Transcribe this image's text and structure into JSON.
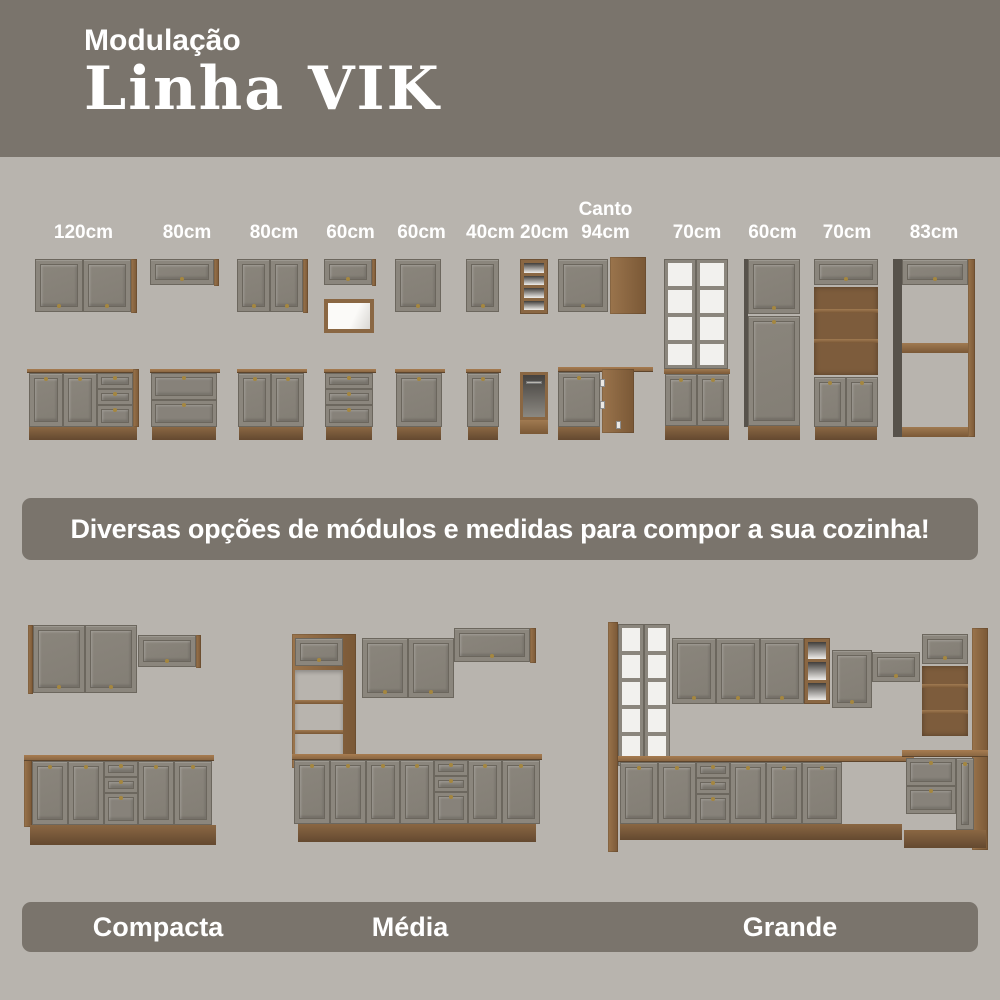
{
  "header": {
    "subtitle": "Modulação",
    "title": "Linha VIK"
  },
  "module_labels": {
    "canto_prefix": "Canto",
    "items": [
      "120cm",
      "80cm",
      "80cm",
      "60cm",
      "60cm",
      "40cm",
      "20cm",
      "94cm",
      "70cm",
      "60cm",
      "70cm",
      "83cm"
    ]
  },
  "banner": {
    "text": "Diversas opções de módulos e medidas para compor a sua cozinha!"
  },
  "kitchens": {
    "items": [
      {
        "label": "Compacta"
      },
      {
        "label": "Média"
      },
      {
        "label": "Grande"
      }
    ]
  },
  "colors": {
    "banner_taupe": "#7a746c",
    "background": "#b8b4ae",
    "cabinet_gray": "#8b867d",
    "wood_brown": "#8a6743",
    "text_white": "#ffffff"
  }
}
